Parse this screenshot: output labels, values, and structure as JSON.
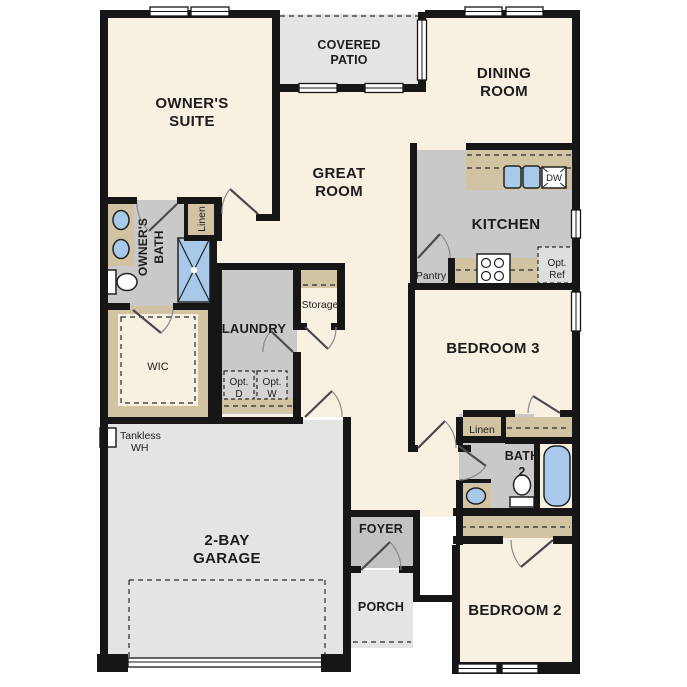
{
  "plan": {
    "rooms": {
      "owners_suite": {
        "line1": "OWNER'S",
        "line2": "SUITE"
      },
      "covered_patio": {
        "line1": "COVERED",
        "line2": "PATIO"
      },
      "dining_room": {
        "line1": "DINING",
        "line2": "ROOM"
      },
      "great_room": {
        "line1": "GREAT",
        "line2": "ROOM"
      },
      "kitchen": {
        "label": "KITCHEN"
      },
      "owners_bath": {
        "line1": "OWNER'S",
        "line2": "BATH"
      },
      "wic": {
        "label": "WIC"
      },
      "laundry": {
        "label": "LAUNDRY"
      },
      "storage": {
        "label": "Storage"
      },
      "pantry": {
        "label": "Pantry"
      },
      "garage": {
        "line1": "2-BAY",
        "line2": "GARAGE"
      },
      "foyer": {
        "label": "FOYER"
      },
      "porch": {
        "label": "PORCH"
      },
      "bedroom3": {
        "label": "BEDROOM 3"
      },
      "bath2": {
        "line1": "BATH",
        "line2": "2"
      },
      "bedroom2": {
        "label": "BEDROOM 2"
      }
    },
    "closets": {
      "owners_linen": "Linen",
      "hall_linen": "Linen"
    },
    "fixtures": {
      "dishwasher": "DW",
      "opt_ref_line1": "Opt.",
      "opt_ref_line2": "Ref",
      "opt_dryer_line1": "Opt.",
      "opt_dryer_line2": "D",
      "opt_washer_line1": "Opt.",
      "opt_washer_line2": "W",
      "tankless_line1": "Tankless",
      "tankless_line2": "WH"
    },
    "colors": {
      "wall": "#161616",
      "floor_cream": "#f8f0e1",
      "patio_gray": "#e4e4e4",
      "room_gray": "#c9c9c9",
      "foyer_gray": "#c2c2c2",
      "cabinet_tan": "#d2c3a3",
      "fixture_blue": "#a8c9e9"
    }
  }
}
